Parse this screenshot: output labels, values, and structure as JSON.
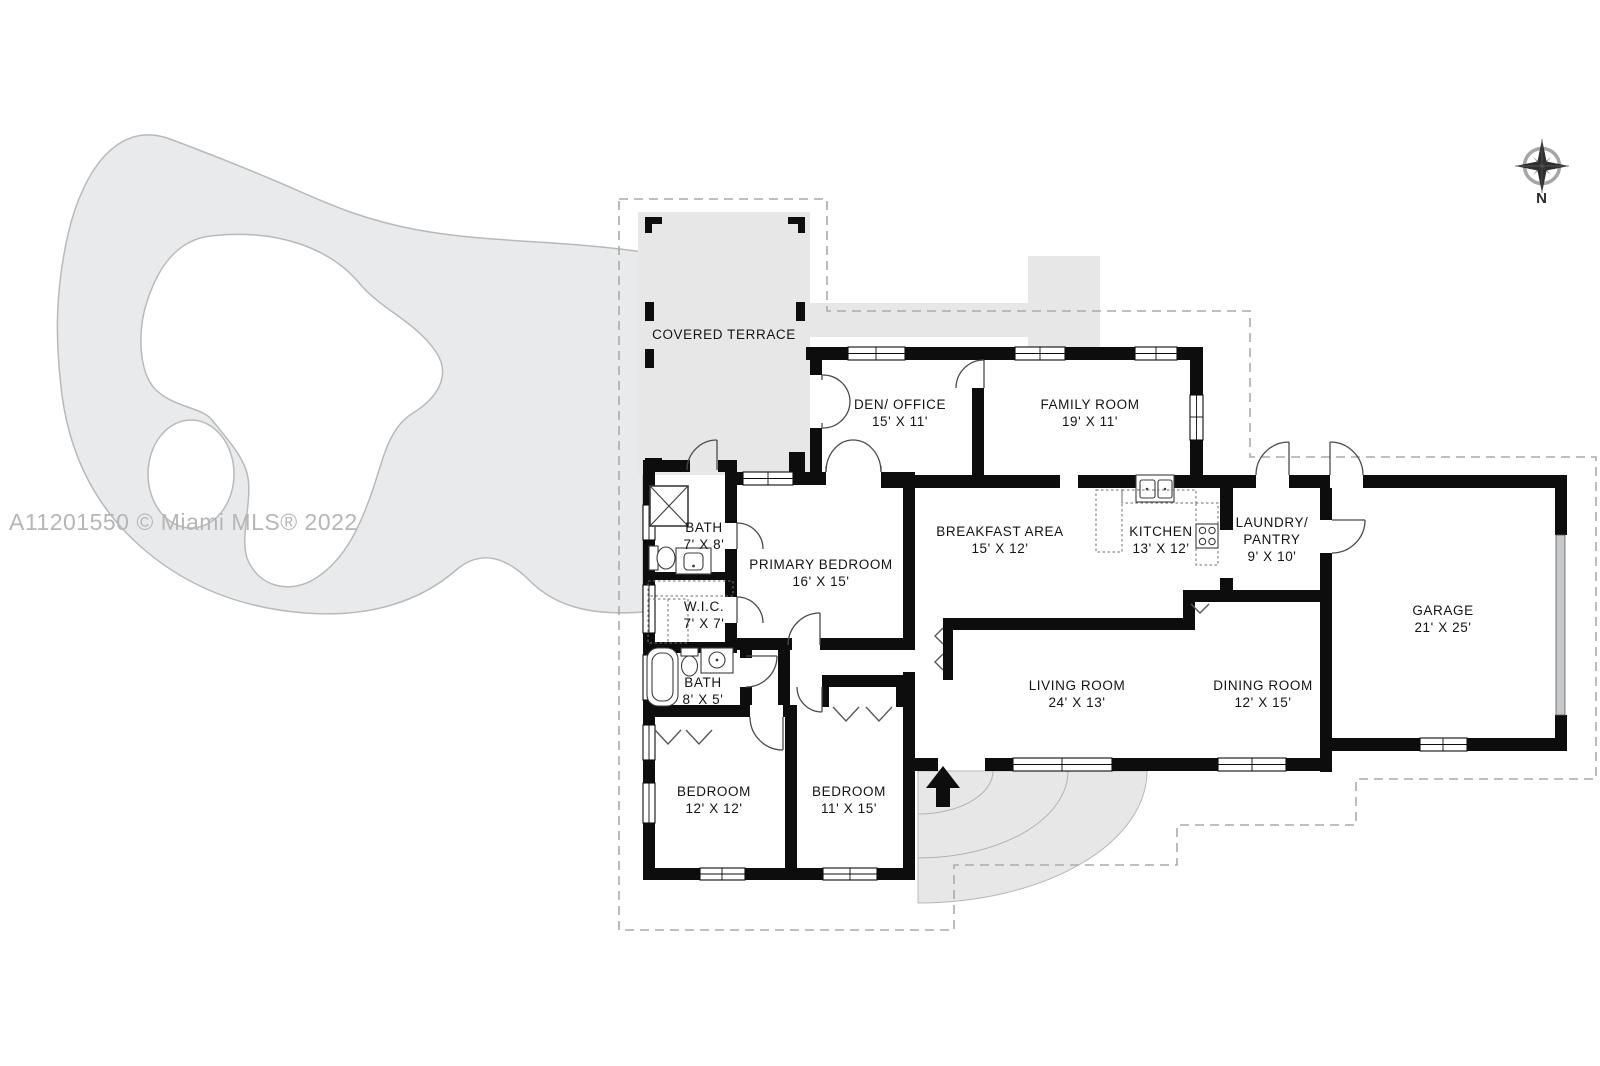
{
  "watermark": "A11201550 © Miami MLS® 2022",
  "compass_label": "N",
  "colors": {
    "wall": "#0d0d0d",
    "door": "#4a4a4a",
    "area": "#e7e7e8",
    "deck": "#e9eaec",
    "outline": "#b7babc",
    "dashed": "#ababab",
    "watermark": "#b6b6b7",
    "label": "#141414"
  },
  "rooms": [
    {
      "id": "covered-terrace",
      "lines": [
        "COVERED TERRACE"
      ],
      "x": 724,
      "y": 326
    },
    {
      "id": "den-office",
      "lines": [
        "DEN/ OFFICE",
        "15' X 11'"
      ],
      "x": 900,
      "y": 396
    },
    {
      "id": "family-room",
      "lines": [
        "FAMILY ROOM",
        "19' X 11'"
      ],
      "x": 1090,
      "y": 396
    },
    {
      "id": "breakfast-area",
      "lines": [
        "BREAKFAST AREA",
        "15' X 12'"
      ],
      "x": 1000,
      "y": 523
    },
    {
      "id": "kitchen",
      "lines": [
        "KITCHEN",
        "13' X 12'"
      ],
      "x": 1161,
      "y": 523
    },
    {
      "id": "laundry-pantry",
      "lines": [
        "LAUNDRY/",
        "PANTRY",
        "9' X 10'"
      ],
      "x": 1272,
      "y": 514
    },
    {
      "id": "garage",
      "lines": [
        "GARAGE",
        "21' X 25'"
      ],
      "x": 1443,
      "y": 602
    },
    {
      "id": "bath-7x8",
      "lines": [
        "BATH",
        "7' X 8'"
      ],
      "x": 704,
      "y": 519
    },
    {
      "id": "primary-bedroom",
      "lines": [
        "PRIMARY BEDROOM",
        "16' X 15'"
      ],
      "x": 821,
      "y": 556
    },
    {
      "id": "wic",
      "lines": [
        "W.I.C.",
        "7' X 7'"
      ],
      "x": 704,
      "y": 598
    },
    {
      "id": "bath-8x5",
      "lines": [
        "BATH",
        "8' X 5'"
      ],
      "x": 703,
      "y": 674
    },
    {
      "id": "bedroom-12x12",
      "lines": [
        "BEDROOM",
        "12' X 12'"
      ],
      "x": 714,
      "y": 783
    },
    {
      "id": "bedroom-11x15",
      "lines": [
        "BEDROOM",
        "11' X 15'"
      ],
      "x": 849,
      "y": 783
    },
    {
      "id": "living-room",
      "lines": [
        "LIVING ROOM",
        "24' X 13'"
      ],
      "x": 1077,
      "y": 677
    },
    {
      "id": "dining-room",
      "lines": [
        "DINING ROOM",
        "12' X 15'"
      ],
      "x": 1263,
      "y": 677
    }
  ]
}
